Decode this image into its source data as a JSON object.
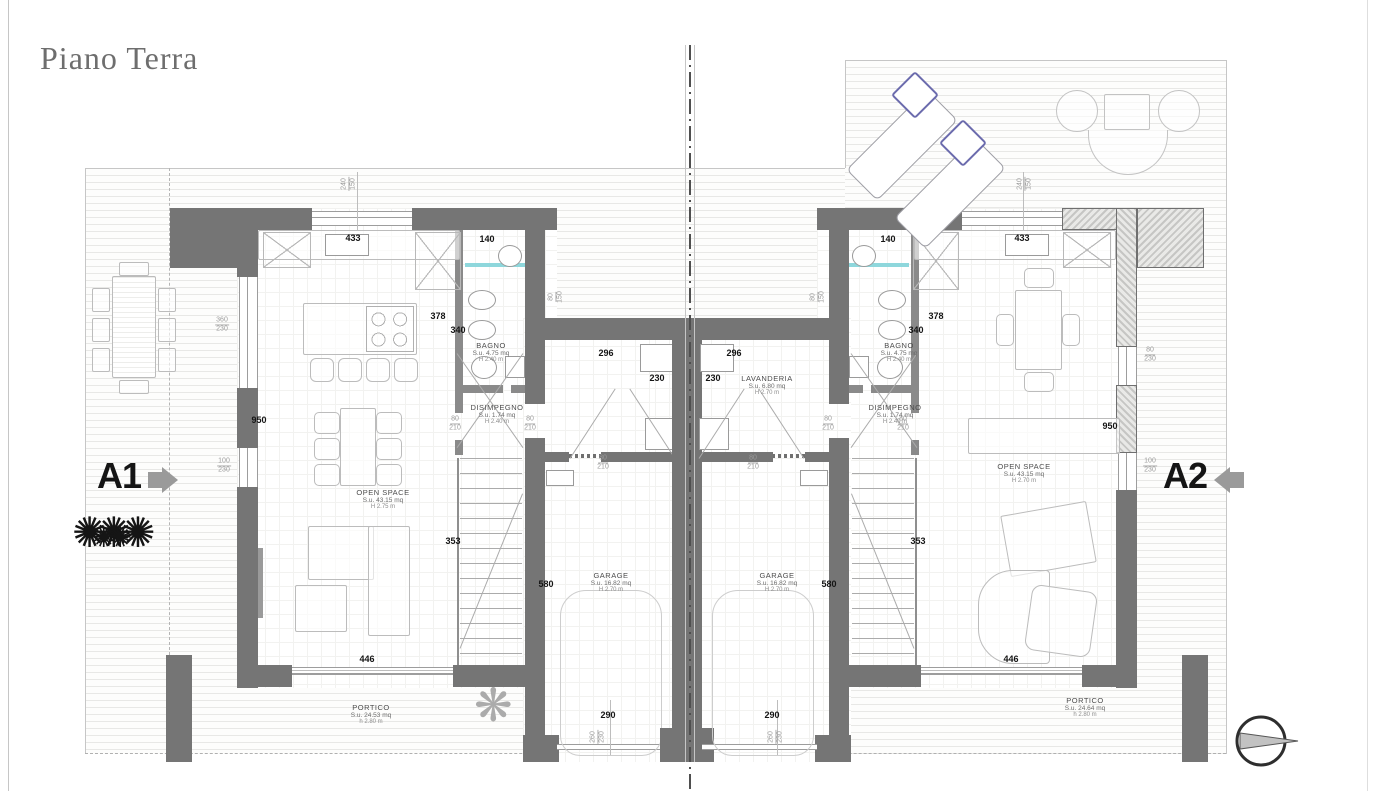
{
  "title": "Piano Terra",
  "units": {
    "a1": "A1",
    "a2": "A2"
  },
  "rooms": {
    "bagno": {
      "name": "BAGNO",
      "area": "S.u. 4.75 mq",
      "height": "H 2.40 m"
    },
    "disimpegno": {
      "name": "DISIMPEGNO",
      "area": "S.u. 1.74 mq",
      "height": "H 2.40 m"
    },
    "open_a1": {
      "name": "OPEN SPACE",
      "area": "S.u. 43.15 mq",
      "height": "H 2.75 m"
    },
    "open_a2": {
      "name": "OPEN SPACE",
      "area": "S.u. 43.15 mq",
      "height": "H 2.70 m"
    },
    "garage": {
      "name": "GARAGE",
      "area": "S.u. 16.82 mq",
      "height": "H 2.70 m"
    },
    "lavanderia": {
      "name": "LAVANDERIA",
      "area": "S.u. 6.80 mq",
      "height": "H 2.70 m"
    },
    "portico_a1": {
      "name": "PORTICO",
      "area": "S.u. 24.53 mq",
      "height": "h 2.80 m"
    },
    "portico_a2": {
      "name": "PORTICO",
      "area": "S.u. 24.64 mq",
      "height": "h 2.80 m"
    }
  },
  "dims": {
    "d433": "433",
    "d140": "140",
    "d378": "378",
    "d340": "340",
    "d950": "950",
    "d296": "296",
    "d230": "230",
    "d353": "353",
    "d580": "580",
    "d446": "446",
    "d290": "290"
  },
  "fracs": {
    "f360_230": {
      "top": "360",
      "bottom": "230"
    },
    "f100_230": {
      "top": "100",
      "bottom": "230"
    },
    "f80_210": {
      "top": "80",
      "bottom": "210"
    },
    "f80_230": {
      "top": "80",
      "bottom": "230"
    },
    "f240_150": {
      "top": "240",
      "bottom": "150"
    },
    "f80_150": {
      "top": "80",
      "bottom": "150"
    },
    "f260_230": {
      "top": "260",
      "bottom": "230"
    }
  },
  "colors": {
    "wall": "#757575",
    "pillow_accent": "#6b6bad",
    "shower_teal": "#8ed7dc"
  },
  "icons": {
    "north_arrow": "north-arrow-icon",
    "tree": "tree-icon",
    "bush": "bush-icon"
  }
}
